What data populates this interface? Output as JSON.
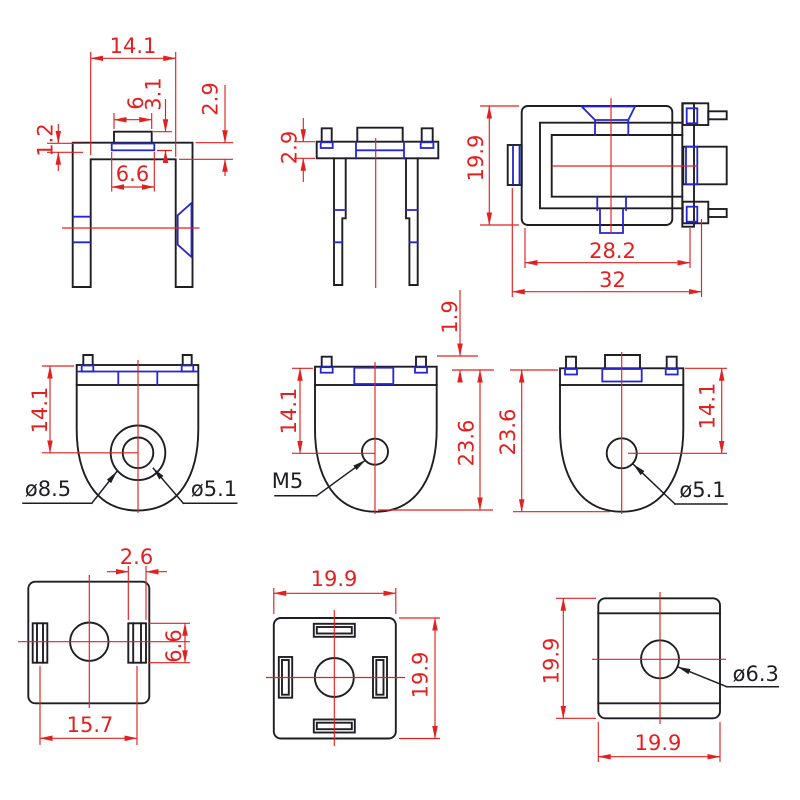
{
  "colors": {
    "background": "#ffffff",
    "line": "#1e1e24",
    "detail": "#2626cf",
    "dimension": "#e32020"
  },
  "views": {
    "v1": {
      "w": "14.1",
      "block_w": "6",
      "step_h": "3.1",
      "plate_t": "2.9",
      "lip": "1.2",
      "slot_w": "6.6"
    },
    "v2": {
      "plate_t": "2.9"
    },
    "v3": {
      "h": "19.9",
      "inner_w": "28.2",
      "outer_w": "32"
    },
    "v4": {
      "h": "14.1",
      "outer_dia": "ø8.5",
      "inner_dia": "ø5.1"
    },
    "v5": {
      "tab_h": "1.9",
      "hole_h": "14.1",
      "total_h": "23.6",
      "thread": "M5"
    },
    "v6": {
      "total_h": "23.6",
      "hole_h": "14.1",
      "dia": "ø5.1"
    },
    "v7": {
      "slot_w": "2.6",
      "slot_h": "6.6",
      "pitch": "15.7"
    },
    "v8": {
      "w": "19.9",
      "h": "19.9"
    },
    "v9": {
      "h": "19.9",
      "w": "19.9",
      "dia": "ø6.3"
    }
  }
}
